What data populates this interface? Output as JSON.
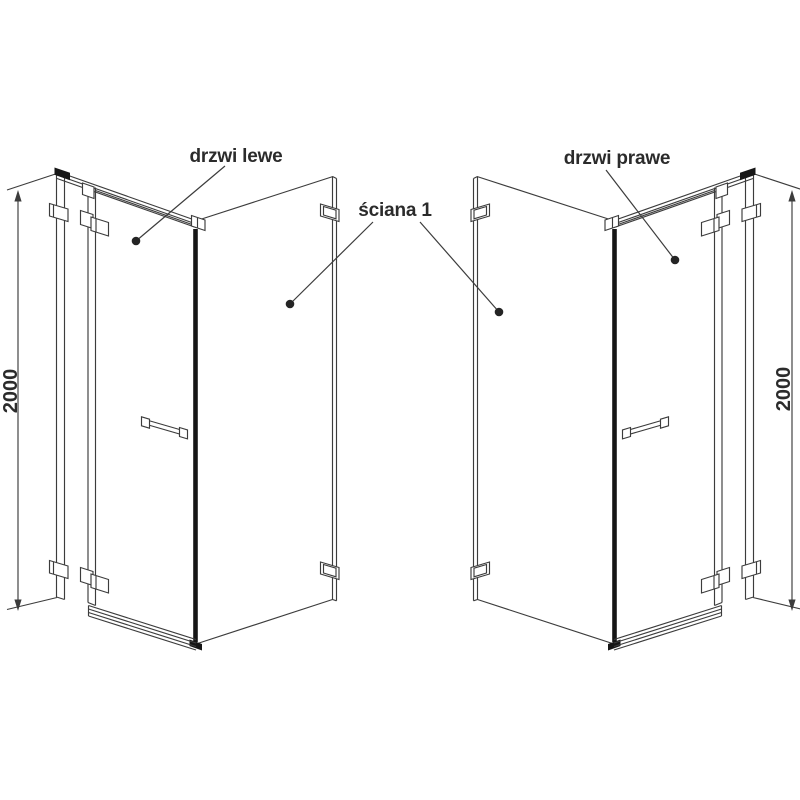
{
  "page": {
    "background": "#ffffff"
  },
  "diagram": {
    "type": "technical-line-drawing",
    "subject": "Shower enclosure door configurations (left door / right door) with side wall",
    "line_color": "#3c3c3c",
    "black_accent": "#161616",
    "text_color": "#2b2b2b",
    "left": {
      "door_label": "drzwi lewe",
      "height_mm": "2000"
    },
    "right": {
      "door_label": "drzwi prawe",
      "height_mm": "2000"
    },
    "wall_label": "ściana 1"
  }
}
